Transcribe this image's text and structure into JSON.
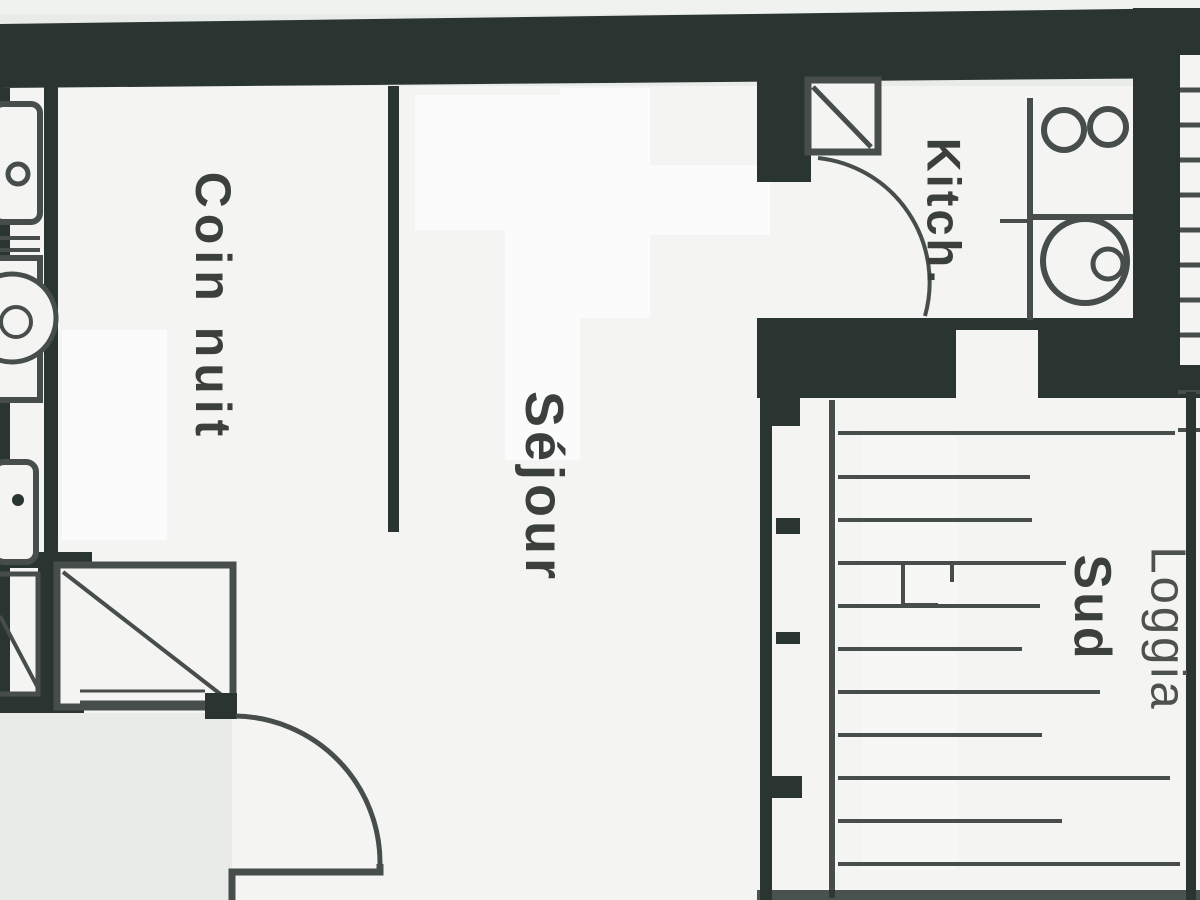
{
  "plan": {
    "type": "apartment-floor-plan",
    "rooms": [
      {
        "id": "coin-nuit",
        "label": "Coin nuit"
      },
      {
        "id": "sejour",
        "label": "Séjour"
      },
      {
        "id": "kitchenette",
        "label": "Kitch."
      },
      {
        "id": "loggia-direction",
        "label": "Sud"
      },
      {
        "id": "loggia",
        "label": "Loggia"
      }
    ],
    "colors": {
      "wall": "#2a3531",
      "line": "#474d4a",
      "paper": "#f4f5f3",
      "outside": "#e8ebe8",
      "label": "#3b403d",
      "label_light": "#4d524f"
    }
  }
}
